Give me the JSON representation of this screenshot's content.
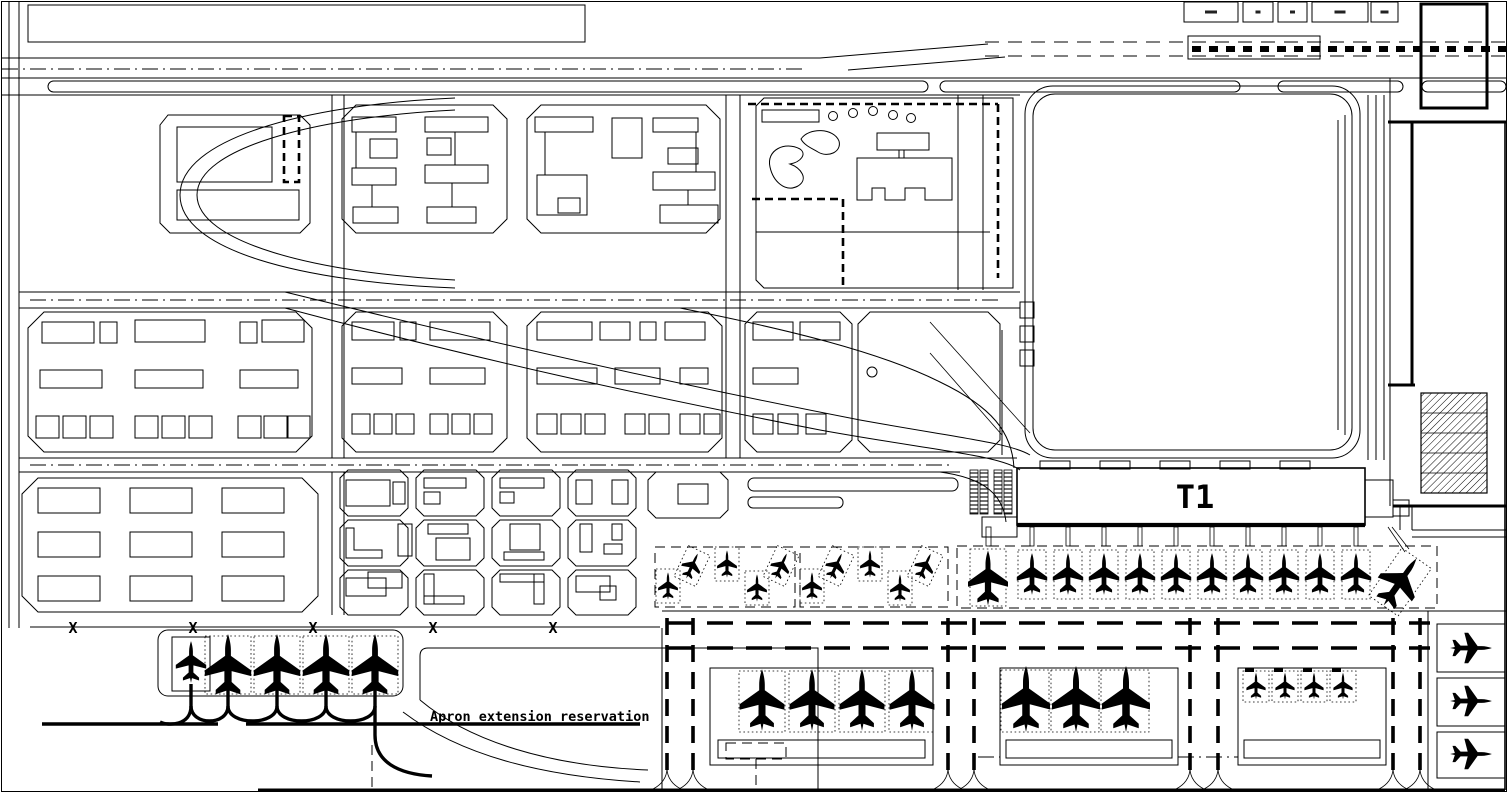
{
  "page": {
    "type": "airport-master-plan-cad-drawing"
  },
  "colors": {
    "line": "#000000",
    "background": "#ffffff"
  },
  "terminal": {
    "label": "T1"
  },
  "apron_note": {
    "label": "Apron extension reservation"
  },
  "boundary_markers": {
    "glyph": "X",
    "y": 633,
    "positions_x": [
      73,
      193,
      313,
      433,
      553
    ]
  },
  "legend": {
    "y": 2,
    "h": 20,
    "boxes": [
      {
        "x": 1184,
        "w": 54,
        "mark_w": 12
      },
      {
        "x": 1243,
        "w": 30,
        "mark_w": 5
      },
      {
        "x": 1278,
        "w": 29,
        "mark_w": 5
      },
      {
        "x": 1312,
        "w": 56,
        "mark_w": 11
      },
      {
        "x": 1371,
        "w": 27,
        "mark_w": 8
      }
    ]
  },
  "aircraft": {
    "groups": [
      {
        "name": "west-apron-stands",
        "planes": [
          {
            "x": 191,
            "y": 662,
            "r": 0,
            "s": 0.95
          },
          {
            "x": 228,
            "y": 666,
            "r": 0,
            "s": 1.45
          },
          {
            "x": 277,
            "y": 666,
            "r": 0,
            "s": 1.45
          },
          {
            "x": 326,
            "y": 666,
            "r": 0,
            "s": 1.45
          },
          {
            "x": 375,
            "y": 666,
            "r": 0,
            "s": 1.45
          }
        ]
      },
      {
        "name": "remote-stand-row-a",
        "planes": [
          {
            "x": 668,
            "y": 586,
            "r": 0,
            "s": 0.62
          },
          {
            "x": 692,
            "y": 566,
            "r": 25,
            "s": 0.62
          },
          {
            "x": 727,
            "y": 564,
            "r": 0,
            "s": 0.62
          },
          {
            "x": 757,
            "y": 588,
            "r": 0,
            "s": 0.62
          },
          {
            "x": 781,
            "y": 566,
            "r": 25,
            "s": 0.62
          }
        ]
      },
      {
        "name": "remote-stand-row-b",
        "planes": [
          {
            "x": 812,
            "y": 586,
            "r": 0,
            "s": 0.62
          },
          {
            "x": 836,
            "y": 566,
            "r": 25,
            "s": 0.62
          },
          {
            "x": 870,
            "y": 564,
            "r": 0,
            "s": 0.62
          },
          {
            "x": 900,
            "y": 588,
            "r": 0,
            "s": 0.62
          },
          {
            "x": 925,
            "y": 566,
            "r": 25,
            "s": 0.62
          }
        ]
      },
      {
        "name": "terminal-contact-stands",
        "planes": [
          {
            "x": 988,
            "y": 578,
            "r": 0,
            "s": 1.25
          },
          {
            "x": 1032,
            "y": 574,
            "r": 0,
            "s": 0.95
          },
          {
            "x": 1068,
            "y": 574,
            "r": 0,
            "s": 0.95
          },
          {
            "x": 1104,
            "y": 574,
            "r": 0,
            "s": 0.95
          },
          {
            "x": 1140,
            "y": 574,
            "r": 0,
            "s": 0.95
          },
          {
            "x": 1176,
            "y": 574,
            "r": 0,
            "s": 0.95
          },
          {
            "x": 1212,
            "y": 574,
            "r": 0,
            "s": 0.95
          },
          {
            "x": 1248,
            "y": 574,
            "r": 0,
            "s": 0.95
          },
          {
            "x": 1284,
            "y": 574,
            "r": 0,
            "s": 0.95
          },
          {
            "x": 1320,
            "y": 574,
            "r": 0,
            "s": 0.95
          },
          {
            "x": 1356,
            "y": 574,
            "r": 0,
            "s": 0.95
          },
          {
            "x": 1400,
            "y": 582,
            "r": 35,
            "s": 1.3
          }
        ]
      },
      {
        "name": "remote-apron-west",
        "planes": [
          {
            "x": 762,
            "y": 700,
            "r": 0,
            "s": 1.4
          },
          {
            "x": 812,
            "y": 700,
            "r": 0,
            "s": 1.4
          },
          {
            "x": 862,
            "y": 700,
            "r": 0,
            "s": 1.4
          },
          {
            "x": 912,
            "y": 700,
            "r": 0,
            "s": 1.4
          }
        ]
      },
      {
        "name": "remote-apron-center",
        "planes": [
          {
            "x": 1026,
            "y": 699,
            "r": 0,
            "s": 1.5
          },
          {
            "x": 1076,
            "y": 699,
            "r": 0,
            "s": 1.5
          },
          {
            "x": 1126,
            "y": 699,
            "r": 0,
            "s": 1.5
          }
        ]
      },
      {
        "name": "remote-apron-east",
        "planes": [
          {
            "x": 1256,
            "y": 686,
            "r": 0,
            "s": 0.6
          },
          {
            "x": 1285,
            "y": 686,
            "r": 0,
            "s": 0.6
          },
          {
            "x": 1314,
            "y": 686,
            "r": 0,
            "s": 0.6
          },
          {
            "x": 1343,
            "y": 686,
            "r": 0,
            "s": 0.6
          }
        ]
      },
      {
        "name": "east-edge-stands",
        "planes": [
          {
            "x": 1471,
            "y": 648,
            "r": 90,
            "s": 0.95
          },
          {
            "x": 1471,
            "y": 701,
            "r": 90,
            "s": 0.95
          },
          {
            "x": 1471,
            "y": 754,
            "r": 90,
            "s": 0.95
          }
        ]
      }
    ]
  }
}
